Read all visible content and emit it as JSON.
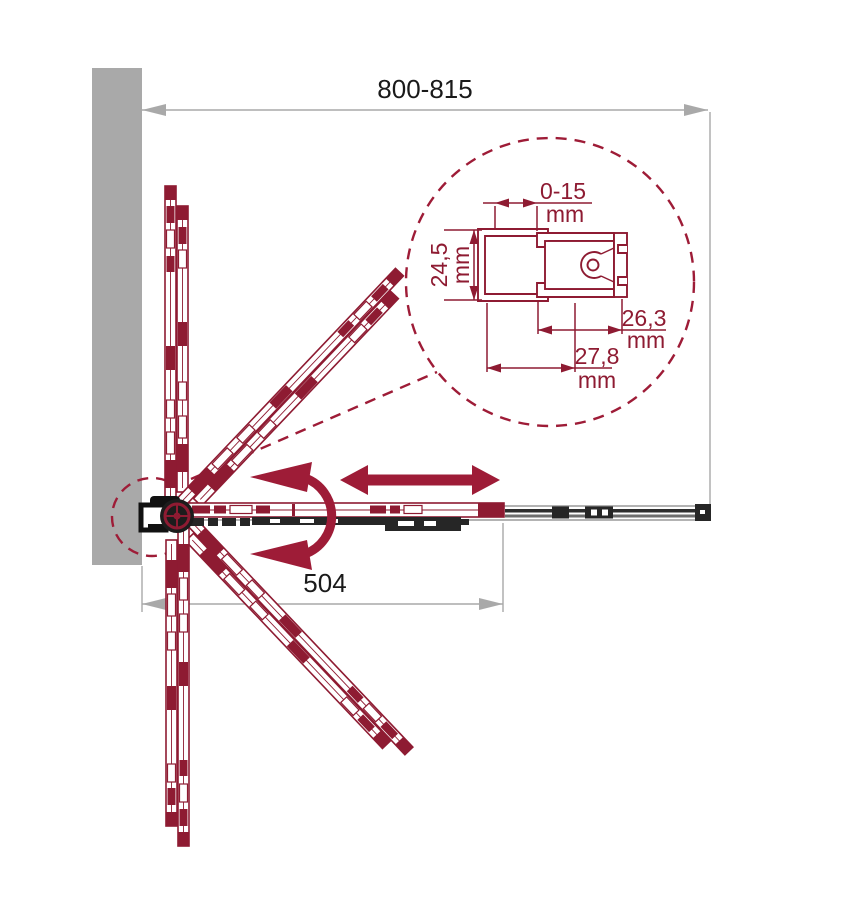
{
  "drawing": {
    "overall_width_label": "800-815",
    "open_panel_width_label": "504",
    "detail": {
      "gap_range": "0-15",
      "gap_unit": "mm",
      "profile_depth": "24,5",
      "profile_depth_unit": "mm",
      "door_profile_width": "26,3",
      "door_profile_width_unit": "mm",
      "wall_profile_width": "27,8",
      "wall_profile_width_unit": "mm"
    },
    "colors": {
      "accent_red": "#8E1B32",
      "arrow_red": "#9E1C37",
      "wall_gray": "#A9A9A9",
      "dimension_gray": "#A9A9A9",
      "hardware_black": "#1C1C1C",
      "text_black": "#1A1A1A"
    }
  }
}
